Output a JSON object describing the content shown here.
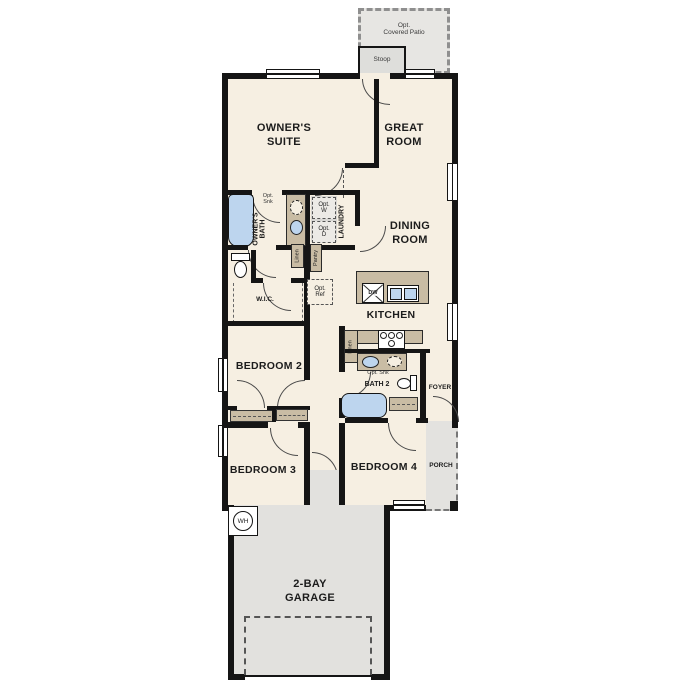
{
  "labels": {
    "patio": "Opt.\nCovered Patio",
    "stoop": "Stoop",
    "owners_suite": "OWNER'S\nSUITE",
    "great_room": "GREAT\nROOM",
    "dining_room": "DINING\nROOM",
    "kitchen": "KITCHEN",
    "owners_bath": "OWNER'S\nBATH",
    "opt_sink_owners": "Opt.\nSnk",
    "opt_washer": "Opt.\nW",
    "opt_dryer": "Opt.\nD",
    "laundry": "LAUNDRY",
    "linen_owners": "Linen",
    "pantry": "Pantry",
    "wic": "W.I.C.",
    "opt_ref": "Opt.\nRef",
    "dishwasher": "DW",
    "linen_hall": "Linen",
    "opt_sink_bath2": "Opt. Snk",
    "bath2": "BATH 2",
    "foyer": "FOYER",
    "bedroom2": "BEDROOM 2",
    "bedroom3": "BEDROOM 3",
    "bedroom4": "BEDROOM 4",
    "porch": "PORCH",
    "garage": "2-BAY\nGARAGE",
    "water_heater": "WH"
  },
  "colors": {
    "wall": "#151515",
    "floor": "#f6efe2",
    "cabinet": "#c9bca4",
    "fixture": "#bdd5ee",
    "outdoor": "#e3e2df",
    "optional_dash": "#555555"
  }
}
